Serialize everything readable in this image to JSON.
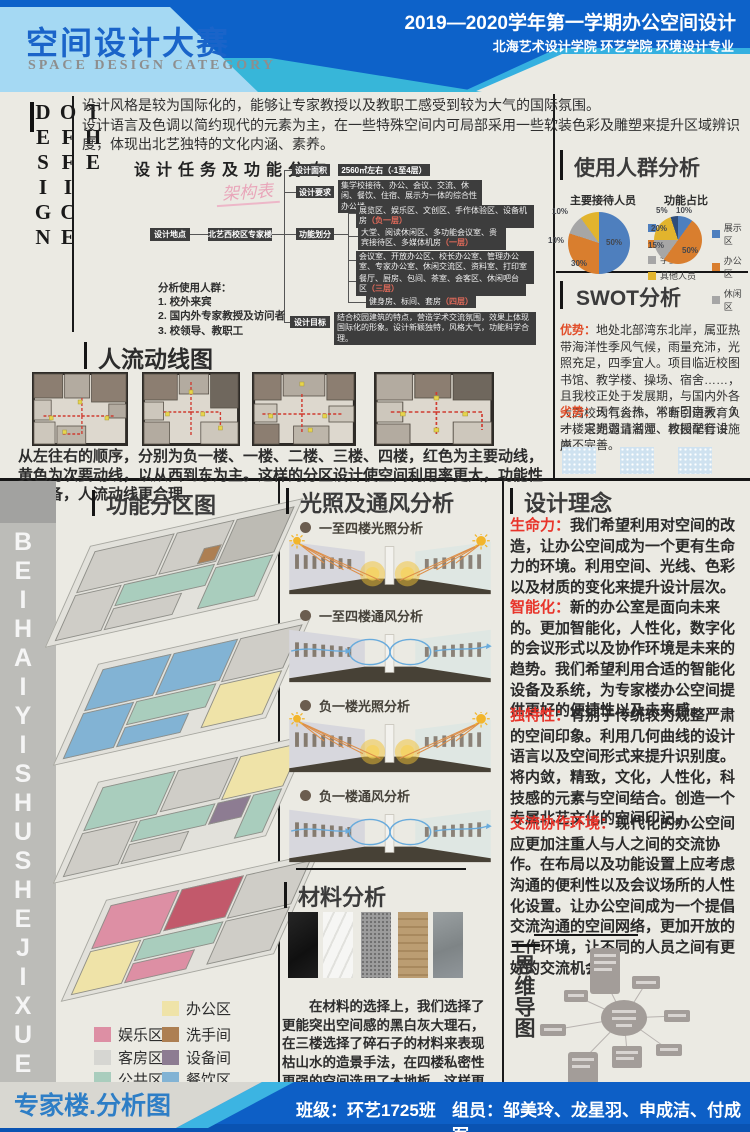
{
  "header": {
    "title": "空间设计大赛",
    "subtitle": "SPACE DESIGN CATEGORY",
    "course": "2019—2020学年第一学期办公空间设计",
    "school": "北海艺术设计学院  环艺学院  环境设计专业"
  },
  "side_label": "THE OFFICE DESIGN",
  "watermark": "BEIHAIYISHUSHEJIXUEYUAN",
  "intro": {
    "line1": "设计风格是较为国际化的，能够让专家教授以及教职工感受到较为大气的国际氛围。",
    "line2": "设计语言及色调以简约现代的元素为主，在一些特殊空间内可局部采用一些软装色彩及雕塑来提升区域辨识度，体现出北艺独特的文化内涵、素养。"
  },
  "tasks": {
    "title": "设计任务及功能分布",
    "note": "架构表",
    "location_label": "设计地点",
    "location_value": "北艺西校区专家楼",
    "area_label": "设计面积",
    "area_value": "2560㎡左右（-1至4层）",
    "require_label": "设计要求",
    "require_value": "集学校接待、办公、会议、交流、休闲、餐饮、住宿、展示为一体的综合性办公楼",
    "zoning_label": "功能划分",
    "zones": [
      {
        "text": "展览区、娱乐区、文创区、手作体验区、设备机房",
        "floor": "（负一层）"
      },
      {
        "text": "大堂、阅读休闲区、多功能会议室、贵宾接待区、多媒体机房",
        "floor": "（一层）"
      },
      {
        "text": "会议室、开放办公区、校长办公室、管理办公室、专家办公室、休闲交流区、资料室、打印室",
        "floor": "（二层）"
      },
      {
        "text": "餐厅、厨房、包间、茶室、会客区、休闲吧台区",
        "floor": "（三层）"
      },
      {
        "text": "健身房、标间、套房",
        "floor": "（四层）"
      }
    ],
    "goal_label": "设计目标",
    "goal_value": "结合校园建筑的特点，营造学术交流氛围，效果上体现国际化的形象。设计新颖独特，风格大气，功能科学合理。",
    "users_title": "分析使用人群：",
    "users": [
      "1. 校外来宾",
      "2. 国内外专家教授及访问者",
      "3. 校领导、教职工"
    ]
  },
  "audience": {
    "title": "使用人群分析",
    "pie1": {
      "title": "主要接待人员",
      "slices": [
        {
          "label": "专家",
          "pct": "50%",
          "value": 50,
          "color": "#4e7fbe"
        },
        {
          "label": "教职工",
          "pct": "30%",
          "value": 30,
          "color": "#d97e2e"
        },
        {
          "label": "学生",
          "pct": "10%",
          "value": 10,
          "color": "#a6a6a6"
        },
        {
          "label": "其他人员",
          "pct": "10%",
          "value": 10,
          "color": "#e2b42d"
        }
      ]
    },
    "pie2": {
      "title": "功能占比",
      "slices": [
        {
          "label": "展示区",
          "pct": "10%",
          "value": 10,
          "color": "#4e7fbe"
        },
        {
          "label": "办公区",
          "pct": "50%",
          "value": 50,
          "color": "#d97e2e"
        },
        {
          "label": "休闲区",
          "pct": "15%",
          "value": 15,
          "color": "#a6a6a6"
        },
        {
          "label": "",
          "pct": "20%",
          "value": 20,
          "color": "#e2b42d"
        },
        {
          "label": "",
          "pct": "5%",
          "value": 5,
          "color": "#2e4d7b"
        }
      ]
    }
  },
  "swot": {
    "title": "SWOT分析",
    "strength_label": "优势：",
    "strength": "地处北部湾东北岸，属亚热带海洋性季风气候，雨量充沛，光照充足，四季宜人。项目临近校图书馆、教学楼、操场、宿舍……，且我校正处于发展期，与国内外各大高校均有合作，不断引进教育人才，定期邀请名师、教授举行讲座。",
    "weakness_label": "劣势：",
    "weakness": "天气炎热、常有回南天、负一楼采光弱且潮湿、校园配套设施尚不完善。"
  },
  "circulation": {
    "title": "人流动线图",
    "caption": "从左往右的顺序，分别为负一楼、一楼、二楼、三楼、四楼，红色为主要动线，黄色为次要动线，以从西到东为主。这样的分区设计使空间利用率更大，功能性更完备，人流动线更合理。"
  },
  "zoning_map": {
    "title": "功能分区图",
    "legend": [
      {
        "label": "办公区",
        "color": "#efe3a8"
      },
      {
        "label": "娱乐区",
        "color": "#dd8fa4"
      },
      {
        "label": "洗手间",
        "color": "#ad7f52"
      },
      {
        "label": "客房区",
        "color": "#d6d6d2"
      },
      {
        "label": "设备间",
        "color": "#8d7c92"
      },
      {
        "label": "公共区",
        "color": "#a9cdbd"
      },
      {
        "label": "餐饮区",
        "color": "#82b3d4"
      }
    ],
    "footer_label": "专家楼.分析图"
  },
  "light_vent": {
    "title": "光照及通风分析",
    "diagrams": [
      "一至四楼光照分析",
      "一至四楼通风分析",
      "负一楼光照分析",
      "负一楼通风分析"
    ]
  },
  "materials": {
    "title": "材料分析",
    "paragraph": "在材料的选择上，我们选择了更能突出空间感的黑白灰大理石，在三楼选择了碎石子的材料来表现枯山水的造景手法，在四楼私密性更强的空间选用了木地板，这样更能保证舒适感。"
  },
  "concept": {
    "title": "设计理念",
    "items": [
      {
        "lead": "生命力：",
        "text": "我们希望利用对空间的改造，让办公空间成为一个更有生命力的环境。利用空间、光线、色彩以及材质的变化来提升设计层次。"
      },
      {
        "lead": "智能化：",
        "text": "新的办公室是面向未来的。更加智能化，人性化，数字化的会议形式以及协作环境是未来的趋势。我们希望利用合适的智能化设备及系统，为专家楼办公空间提供更好的便捷性以及未来感。"
      },
      {
        "lead": "独特性：",
        "text": "有别于传统较为规整严肃的空间印象。利用几何曲线的设计语言以及空间形式来提升识别度。将内敛，精致，文化，人性化，科技感的元素与空间结合。创造一个专属北艺文化的空间印记。"
      },
      {
        "lead": "交流协作环境：",
        "text": "现代化的办公空间应更加注重人与人之间的交流协作。在布局以及功能设置上应考虑沟通的便利性以及会议场所的人性化设置。让办公空间成为一个提倡交流沟通的空间网络，更加开放的工作环境，让不同的人员之间有更好的交流机会。"
      }
    ]
  },
  "mindmap": {
    "title": "思维导图"
  },
  "footer": {
    "class_label": "班级：",
    "class_value": "环艺1725班",
    "team_label": "组员：",
    "team_value": "邹美玲、龙星羽、申成洁、付成军"
  },
  "colors": {
    "header_blue": "#0d62c9",
    "panel_light_blue": "#a5d9f3",
    "accent_cyan": "#37b6d9",
    "title_blue": "#1a64c9",
    "red_accent": "#e8342a",
    "swot_orange": "#e14e2a",
    "footer_blue": "#0d5fc6",
    "flow_box_dark": "#3d3d3d"
  }
}
